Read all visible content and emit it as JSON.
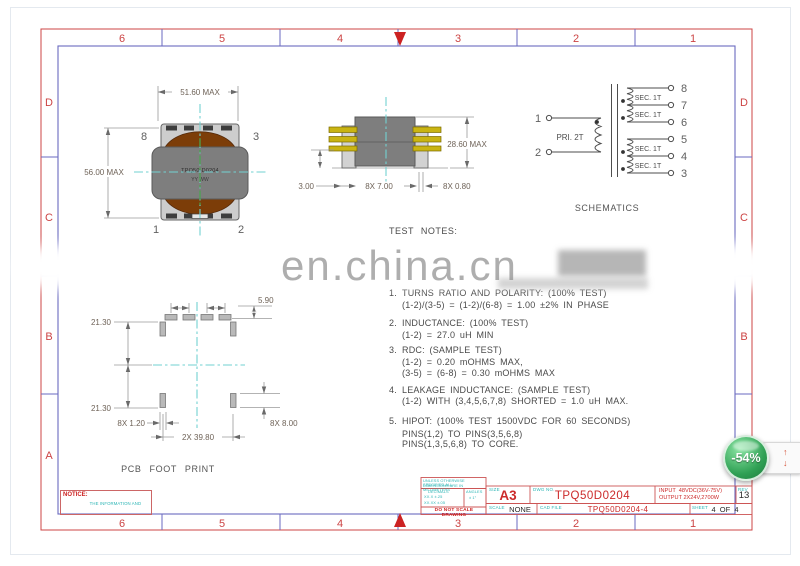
{
  "frame": {
    "cols": [
      "6",
      "5",
      "4",
      "3",
      "2",
      "1"
    ],
    "rows": [
      "D",
      "C",
      "B",
      "A"
    ]
  },
  "watermark": {
    "text": "en.china.cn"
  },
  "front_view": {
    "dim_width": "51.60 MAX",
    "dim_height": "56.00 MAX",
    "pin_tl": "8",
    "pin_tr": "3",
    "pin_bl": "1",
    "pin_br": "2",
    "part_label": "TPQ50-D0204",
    "date_code": "YY WW"
  },
  "side_view": {
    "dim_height": "28.60 MAX",
    "dim_standoff": "3.00",
    "dim_pitch": "8X 7.00",
    "dim_pin": "8X 0.80"
  },
  "schematic": {
    "title": "SCHEMATICS",
    "primary_label": "PRI. 2T",
    "left_pins": [
      "1",
      "2"
    ],
    "right_pins": [
      "8",
      "7",
      "6",
      "5",
      "4",
      "3"
    ],
    "sec_labels": [
      "SEC. 1T",
      "SEC. 1T",
      "SEC. 1T",
      "SEC. 1T"
    ]
  },
  "test_notes": {
    "title": "TEST NOTES:",
    "items": [
      {
        "num": "1.",
        "lines": [
          "TURNS RATIO AND POLARITY: (100% TEST)",
          "(1-2)/(3-5) = (1-2)/(6-8) = 1.00 ±2% IN PHASE"
        ]
      },
      {
        "num": "2.",
        "lines": [
          "INDUCTANCE: (100% TEST)",
          "(1-2) = 27.0 uH MIN"
        ]
      },
      {
        "num": "3.",
        "lines": [
          "RDC: (SAMPLE TEST)",
          "(1-2) = 0.20 mOHMS MAX,",
          "(3-5) = (6-8) = 0.30 mOHMS MAX"
        ]
      },
      {
        "num": "4.",
        "lines": [
          "LEAKAGE INDUCTANCE: (SAMPLE TEST)",
          "(1-2) WITH (3,4,5,6,7,8) SHORTED = 1.0 uH MAX."
        ]
      },
      {
        "num": "5.",
        "lines": [
          "HIPOT: (100% TEST 1500VDC FOR 60 SECONDS)",
          "PINS(1,2) TO PINS(3,5,6,8)",
          "PINS(1,3,5,6,8) TO CORE."
        ]
      }
    ]
  },
  "footprint": {
    "title": "PCB FOOT PRINT",
    "dim_pad_gap": "5.90",
    "dim_upper": "21.30",
    "dim_lower": "21.30",
    "dim_pad_width": "8X 1.20",
    "dim_span": "2X 39.80",
    "dim_pad_length": "8X 8.00"
  },
  "notice": {
    "label": "NOTICE:",
    "text": "THE INFORMATION AND DESIGN CONTAINED HEREIN IS THE PROPERTY OF TECHCAM AND RESERVED ALL RIGHTS THERETO."
  },
  "title_block": {
    "tol_line1": "UNLESS OTHERWISE SPECIFIED ALL",
    "tol_line2": "DIMENSIONS ARE IN MILLIMETERS",
    "decimals_label": "DECIMALS",
    "angles_label": "ANGLES",
    "tol_dec1": "XX.X  ±.25",
    "tol_dec2": "XX.XX ±.05",
    "tol_angle": "± 1°",
    "warning": "DO NOT SCALE DRAWING",
    "size_label": "SIZE",
    "size": "A3",
    "dwg_label": "DWG NO.",
    "dwg_no": "TPQ50D0204",
    "spec_line1": "INPUT  48VDC(36V-75V)",
    "spec_line2": "OUTPUT 2X24V,2700W",
    "rev_label": "REV",
    "rev": "13",
    "scale_label": "SCALE",
    "scale": "NONE",
    "cad_label": "CAD FILE",
    "cad_file": "TPQ50D0204-4",
    "sheet_label": "SHEET",
    "sheet": "4  OF  4"
  },
  "viewer": {
    "badge": "-54%",
    "up_arrow": "↑",
    "down_arrow": "↓"
  },
  "colors": {
    "frame_red": "#cc4444",
    "frame_blue": "#6a6ac0",
    "centerline_cyan": "#72d2d2",
    "label_cyan": "#2cb5b5",
    "value_red": "#cc2a2a",
    "badge_green": "#2fa054",
    "core_brown": "#7c3d08",
    "body_gray": "#7e7e7e",
    "pin_yellow": "#c9b412"
  }
}
